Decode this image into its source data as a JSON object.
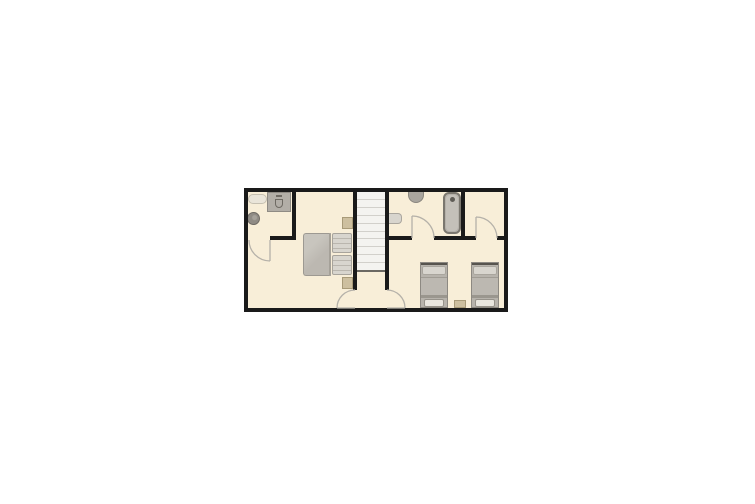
{
  "canvas": {
    "background": "#ffffff"
  },
  "floorplan": {
    "type": "floor-plan",
    "colors": {
      "canvas": "#ffffff",
      "wall": "#1a1a1a",
      "floor": "#f8eed8",
      "stair-tread": "#f4f3f0",
      "stair-line": "#d2d0cb",
      "stair-end": "#6b6862",
      "door": "#b5b1a9",
      "furniture": "#bcb8b1",
      "furniture-light": "#d8d5ce",
      "linen": "#e9e6df",
      "bed-frame": "#57544e",
      "wood": "#cdbf9f",
      "wood-dark": "#a89a78",
      "fixture": "#b2aea7",
      "fixture-dark": "#6e6a63",
      "porcelain": "#eae5d9"
    },
    "staircase": {
      "treads": 10
    },
    "rooms": [
      {
        "id": "bathroom-main",
        "fixtures": [
          "vanity-sink",
          "toilet-unit",
          "round-basin"
        ]
      },
      {
        "id": "master-bedroom",
        "fixtures": [
          "double-bed",
          "nightstand",
          "nightstand"
        ]
      },
      {
        "id": "staircase-hall",
        "fixtures": [
          "stairs"
        ]
      },
      {
        "id": "bathroom-second",
        "fixtures": [
          "toilet",
          "wall-sink",
          "bathtub"
        ]
      },
      {
        "id": "closet",
        "fixtures": []
      },
      {
        "id": "twin-bedroom",
        "fixtures": [
          "single-bed",
          "single-bed",
          "nightstand"
        ]
      }
    ],
    "doors": [
      {
        "id": "door-bathroom-main"
      },
      {
        "id": "door-master-bedroom"
      },
      {
        "id": "door-twin-bedroom"
      },
      {
        "id": "door-bathroom-second"
      },
      {
        "id": "door-closet"
      }
    ]
  }
}
